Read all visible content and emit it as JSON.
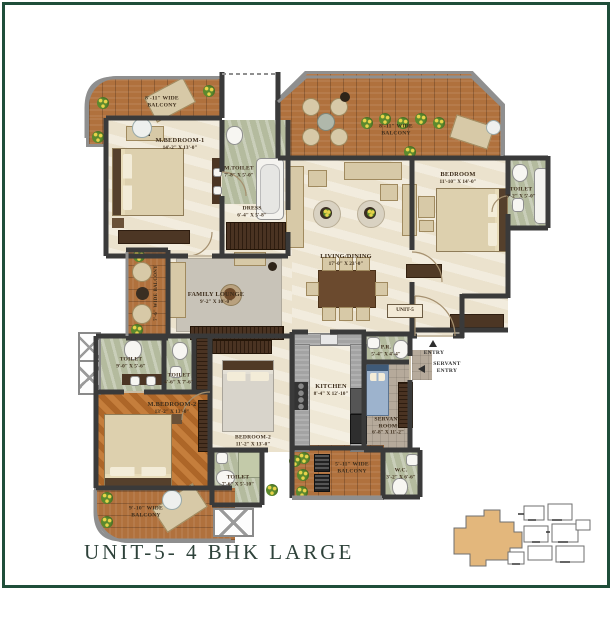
{
  "title": "UNIT-5- 4 BHK LARGE",
  "unit_badge": "UNIT-5",
  "colors": {
    "frame_green": "#1f4e3a",
    "wall_dark": "#3a3a3a",
    "floor_cream": "#ebe2cd",
    "floor_wood": "#b0713d",
    "floor_herringbone": "#b87235",
    "floor_toilet_green": "#b4bb9e",
    "keyplan_highlight": "#e3b77c",
    "title_text": "#2e423a"
  },
  "rooms": {
    "mbedroom1": {
      "name": "M.BEDROOM-1",
      "dims": "14'-2\" X 13'-0\""
    },
    "mtoilet": {
      "name": "M.TOILET",
      "dims": "7'-8\" X 5'-0\""
    },
    "dress": {
      "name": "DRESS",
      "dims": "6'-4\" X 5'-8\""
    },
    "bedroom": {
      "name": "BEDROOM",
      "dims": "11'-10\" X 14'-0\""
    },
    "toilet_tr": {
      "name": "TOILET",
      "dims": "8'-2\" X 5'-0\""
    },
    "living": {
      "name": "LIVING/DINING",
      "dims": "17'-0\" X 23'-0\""
    },
    "family": {
      "name": "FAMILY LOUNGE",
      "dims": "9'-2\" X 10'-0\""
    },
    "mbedroom2": {
      "name": "M.BEDROOM-2",
      "dims": "13'-2\" X 13'-0\""
    },
    "bedroom2": {
      "name": "BEDROOM-2",
      "dims": "11'-2\" X 13'-0\""
    },
    "toilet_ml": {
      "name": "TOILET",
      "dims": "9'-0\" X 5'-6\""
    },
    "toilet_sm": {
      "name": "TOILET",
      "dims": "4'-6\" X 7'-6\""
    },
    "toilet_b": {
      "name": "TOILET",
      "dims": "7'-6\" X 5'-10\""
    },
    "kitchen": {
      "name": "KITCHEN",
      "dims": "8'-4\" X 12'-10\""
    },
    "pr": {
      "name": "P.R.",
      "dims": "5'-4\" X 4'-4\""
    },
    "servant": {
      "name": "SERVANT ROOM",
      "dims": "6'-8\" X 11'-2\""
    },
    "wc": {
      "name": "W.C.",
      "dims": "3'-2\" X 6'-6\""
    }
  },
  "balconies": {
    "top_left": {
      "line1": "8'-11\" WIDE",
      "line2": "BALCONY"
    },
    "top_right": {
      "line1": "8'-11\" WIDE",
      "line2": "BALCONY"
    },
    "left": {
      "line1": "7'-6\" WIDE BALCONY",
      "line2": ""
    },
    "bottom_left": {
      "line1": "9'-10\" WIDE",
      "line2": "BALCONY"
    },
    "bottom": {
      "line1": "5'-11\" WIDE",
      "line2": "BALCONY"
    }
  },
  "annotations": {
    "entry": "ENTRY",
    "servant_entry_1": "SERVANT",
    "servant_entry_2": "ENTRY"
  }
}
